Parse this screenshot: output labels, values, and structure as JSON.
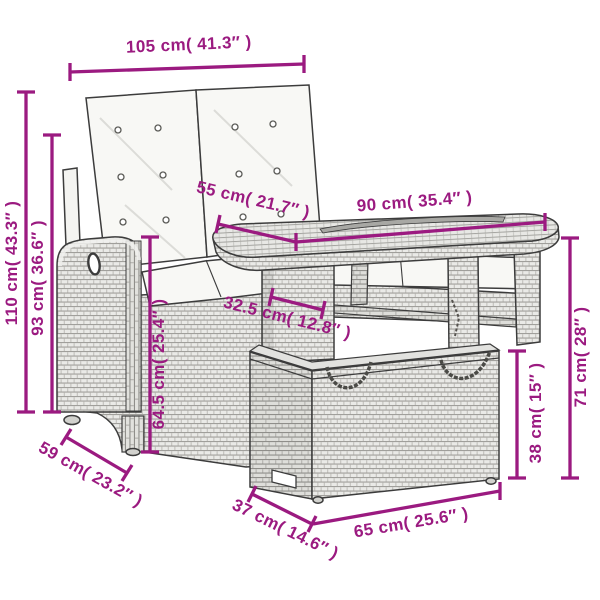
{
  "diagram": {
    "kind": "product-dimension-line-drawing",
    "subject": "poly rattan garden bench with cushions and storage table set",
    "accent_color": "#9B1A80",
    "outline_color": "#3C3C3C",
    "rattan_light": "#EAEAE7",
    "rattan_mid": "#A3A29E",
    "cushion_color": "#F8F8F5",
    "dimensions": [
      {
        "id": "bench-width",
        "text": "105 cm( 41.3″ )"
      },
      {
        "id": "bench-total-height",
        "text": "110 cm( 43.3″ )"
      },
      {
        "id": "bench-backrest-height",
        "text": "93 cm( 36.6″ )"
      },
      {
        "id": "bench-seat-depth",
        "text": "55 cm( 21.7″ )"
      },
      {
        "id": "table-length",
        "text": "90 cm( 35.4″ )"
      },
      {
        "id": "table-base-depth",
        "text": "32.5 cm( 12.8″ )"
      },
      {
        "id": "bench-arm-height",
        "text": "64.5 cm( 25.4″ )"
      },
      {
        "id": "table-height",
        "text": "71 cm( 28″ )"
      },
      {
        "id": "storage-box-height",
        "text": "38 cm( 15″ )"
      },
      {
        "id": "bench-depth",
        "text": "59 cm( 23.2″ )"
      },
      {
        "id": "box-depth",
        "text": "37 cm( 14.6″ )"
      },
      {
        "id": "box-width",
        "text": "65 cm( 25.6″ )"
      }
    ]
  }
}
